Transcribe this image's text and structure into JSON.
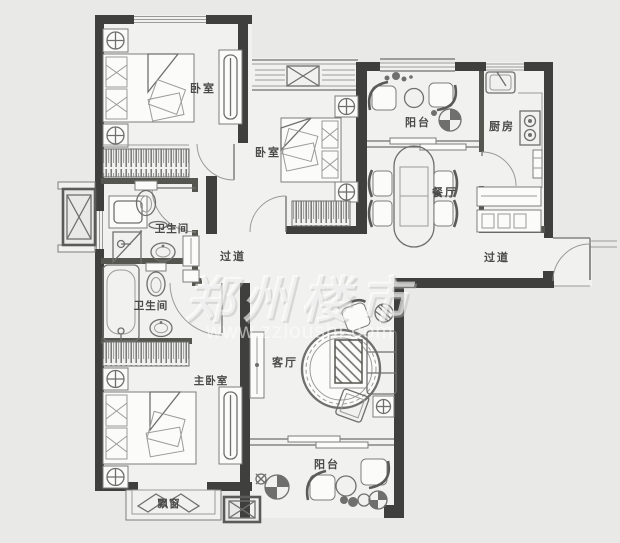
{
  "page": {
    "type": "apartment-floor-plan",
    "background": "#e9e9e7"
  },
  "colors": {
    "wall": "#3f403e",
    "partition": "#55564f",
    "floor": "#f1f1ef",
    "furniture_line": "#9a9a98",
    "label_text": "#4a4a48",
    "watermark": "#ffffff"
  },
  "rooms": [
    {
      "id": "bedroom-1",
      "label": "卧室"
    },
    {
      "id": "bedroom-2",
      "label": "卧室"
    },
    {
      "id": "balcony-top",
      "label": "阳台"
    },
    {
      "id": "kitchen",
      "label": "厨房"
    },
    {
      "id": "dining",
      "label": "餐厅"
    },
    {
      "id": "hallway-right",
      "label": "过道"
    },
    {
      "id": "hallway-center",
      "label": "过道"
    },
    {
      "id": "bathroom-1",
      "label": "卫生间"
    },
    {
      "id": "bathroom-2",
      "label": "卫生间"
    },
    {
      "id": "master-bedroom",
      "label": "主卧室"
    },
    {
      "id": "living-room",
      "label": "客厅"
    },
    {
      "id": "balcony-bottom",
      "label": "阳台"
    },
    {
      "id": "bay-window",
      "label": "飘窗"
    }
  ],
  "watermark": {
    "brand": "郑州楼市",
    "url": "www.zzloushi.com"
  }
}
